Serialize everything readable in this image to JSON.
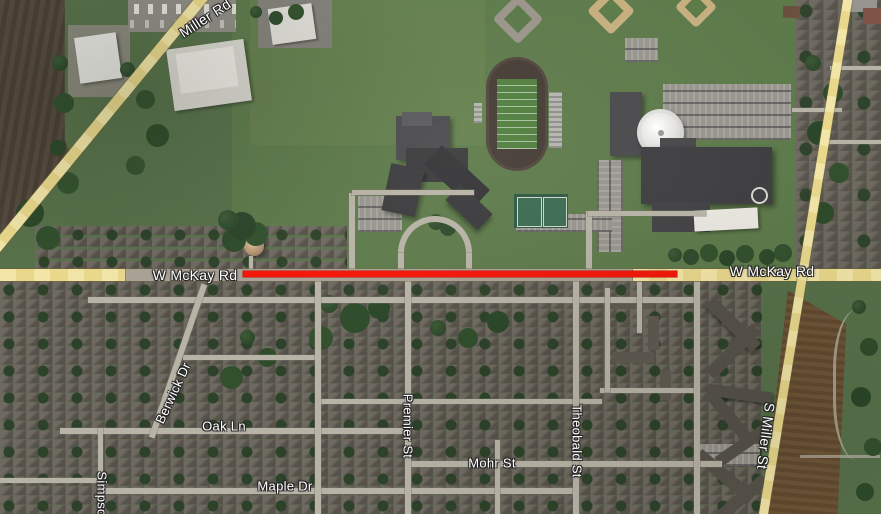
{
  "map": {
    "view": "Satellite",
    "overlay": {
      "highlighted_road": "W McKay Rd",
      "highlight_color": "#f41507"
    },
    "labels": {
      "miller_rd": "Miller Rd",
      "w_mckay_left": "W McKay Rd",
      "w_mckay_right": "W McKay Rd",
      "berwick_dr": "Berwick Dr",
      "oak_ln": "Oak Ln",
      "premier_st": "Premier St",
      "theobald_st": "Theobald St",
      "mohr_st": "Mohr St",
      "maple_dr": "Maple Dr",
      "s_miller_st": "S Miller St",
      "simpson_st": "Simpso"
    },
    "palette": {
      "major_road": "#e9d88c",
      "minor_road": "#b7b3a7",
      "label_text": "#ffffff"
    }
  }
}
